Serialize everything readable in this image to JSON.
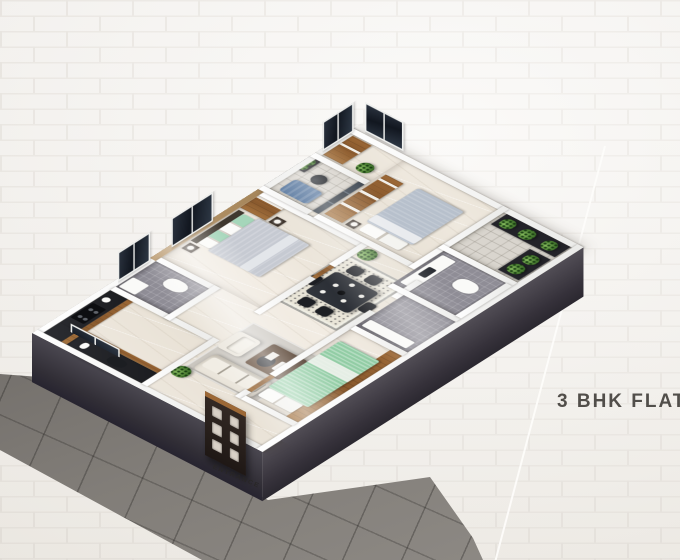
{
  "plan": {
    "title": "3 BHK FLAT",
    "entrance_label": "ENTRANCE"
  },
  "palette": {
    "wall_brick": "#f5f3ef",
    "brick_mortar": "#e8e4de",
    "title_text": "#514e4a",
    "accent_line": "#fdfcfa",
    "pavement_dark": "#57534f",
    "pavement_light": "#908c87",
    "plinth": "#39363c",
    "wall_white": "#fbfbfa",
    "floor_marble": "#ece6dc",
    "accent_wall_tan": "#b09066",
    "wood": "#9c6836",
    "window_glass": "#161a21",
    "balcony_glass": "#2c3642",
    "bathroom_tile": "#8f8d96",
    "bed_green": "#92cda5",
    "bed_gray": "#c6cad2",
    "bed_blue_gray": "#b7c0cc",
    "sofa_cream": "#eae5db",
    "dining_table": "#2a2d33",
    "rug": "#e9e5d8",
    "plant_green": "#4d8034",
    "lounge_blue": "#50719a",
    "door_dark": "#2a211d",
    "door_slot": "#d9d1c7"
  }
}
